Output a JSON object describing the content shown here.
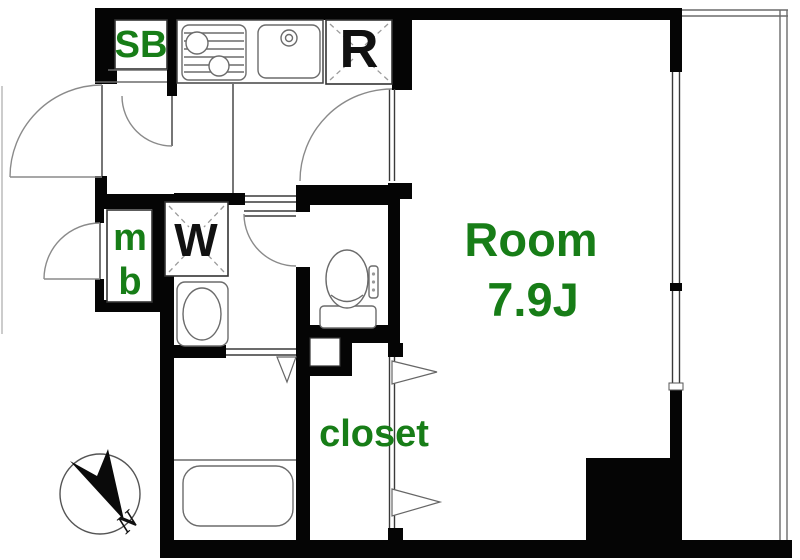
{
  "plan": {
    "unit_labels": {
      "shoe_box": "SB",
      "refrigerator_space": "R",
      "meter_box_line1": "m",
      "meter_box_line2": "b",
      "washing_machine": "W",
      "main_room_name": "Room",
      "main_room_size": "7.9J",
      "closet": "closet"
    },
    "compass": {
      "north": "N"
    },
    "colors": {
      "label_green": "#177D17",
      "label_black": "#111111",
      "wall_black": "#050505"
    }
  }
}
